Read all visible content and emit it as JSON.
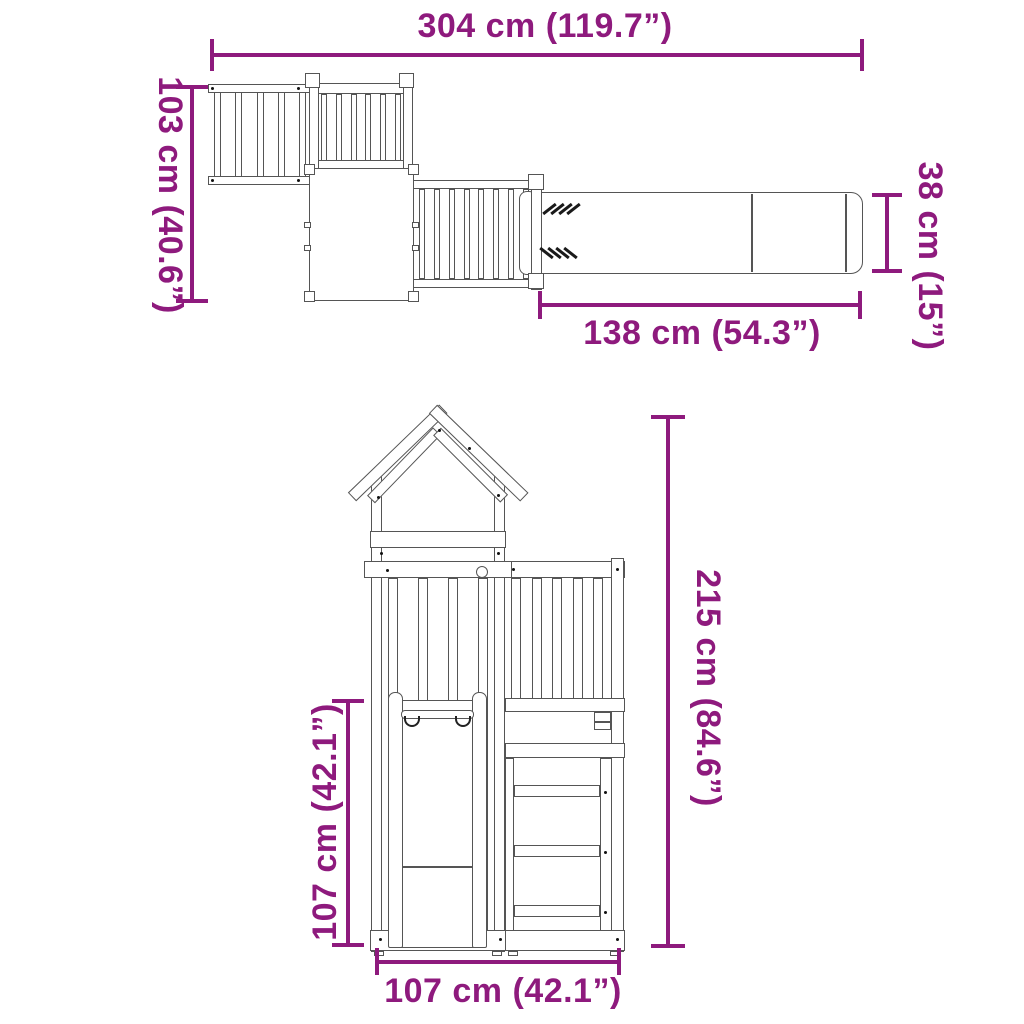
{
  "colors": {
    "dimension_accent": "#8E1A7D",
    "line_art": "#555555",
    "background": "#FFFFFF"
  },
  "top_view": {
    "overall_width": "304 cm (119.7”)",
    "overall_depth": "103 cm (40.6”)",
    "slide_width": "38 cm (15”)",
    "slide_length": "138 cm (54.3”)"
  },
  "front_view": {
    "overall_height": "215 cm (84.6”)",
    "platform_height": "107 cm (42.1”)",
    "base_width": "107 cm (42.1”)"
  }
}
